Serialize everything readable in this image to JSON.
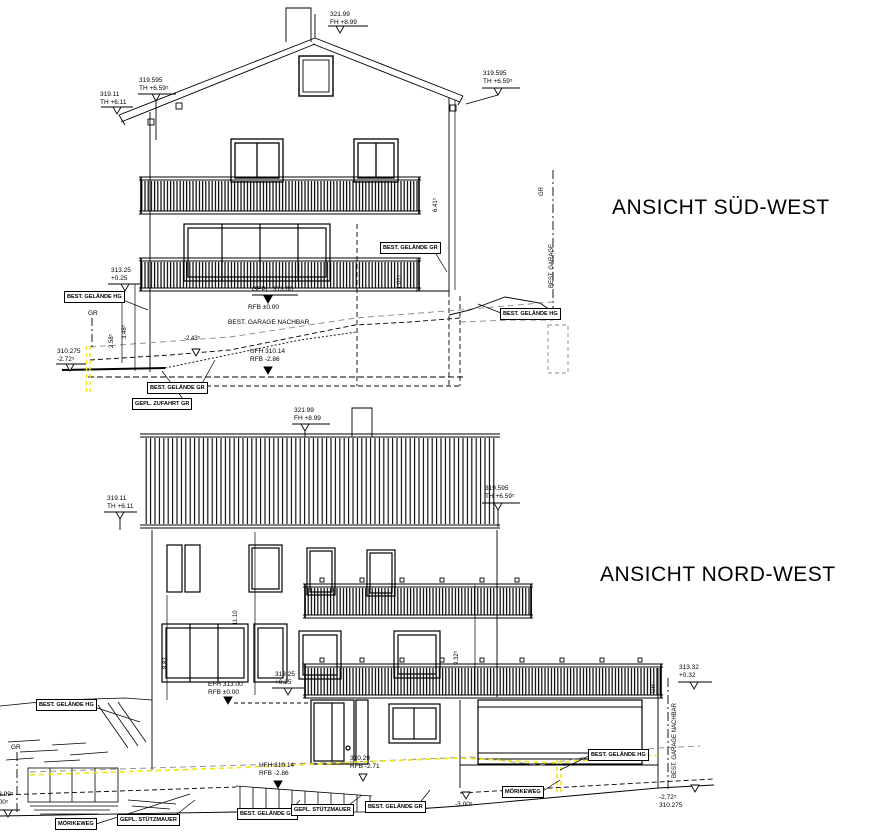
{
  "titles": {
    "sued_west": "ANSICHT SÜD-WEST",
    "nord_west": "ANSICHT NORD-WEST"
  },
  "colors": {
    "line": "#000000",
    "terrain_dash": "#8a8a8a",
    "highlight_yellow": "#f0e612"
  },
  "labels": {
    "sw_ridge": "321.99\nFH +8.99",
    "sw_eave_left_outer": "319.11\nTH +6.11",
    "sw_eave_left_inner": "319.595\nTH +6.59⁵",
    "sw_eave_right": "319.595\nTH +6.59⁵",
    "sw_level_31325": "313.25\n+0.25",
    "sw_hg_left": "BEST. GELÄNDE HG",
    "sw_gr_left": "GR",
    "sw_gepl": "GEPL. 313.00",
    "sw_rfb0": "RFB ±0.00",
    "sw_garage_nachbar": "BEST. GARAGE NACHBAR",
    "sw_ufh": "UFH 310.14\nRFB -2.86",
    "sw_gr_mid": "BEST. GELÄNDE GR",
    "sw_gr_right": "GR",
    "sw_garage_vert": "BEST. GARAGE",
    "sw_hg_right": "BEST. GELÄNDE HG",
    "sw_level_310275": "310.275\n-2.72⁵",
    "sw_gr_bottom": "BEST. GELÄNDE GR",
    "sw_zufahrt": "GEPL. ZUFAHRT GR",
    "sw_dim_258": "2.58⁵",
    "sw_dim_348": "3.48⁵",
    "sw_dim_243": "-2.43⁵",
    "sw_dim_641": "6.41⁵",
    "sw_dim_101": "1.01⁵",
    "nw_ridge": "321.99\nFH +8.99",
    "nw_eave_left": "319.11\nTH +6.11",
    "nw_eave_right": "319.595\nTH +6.59⁵",
    "nw_dim_1110": "11.10",
    "nw_dim_882": "8.82",
    "nw_dim_9325": "9.32⁵",
    "nw_level_31325": "313.25\n+0.25",
    "nw_efh": "EFH 313.00\nRFB ±0.00",
    "nw_level_31332": "313.32\n+0.32",
    "nw_gr_right": "GR",
    "nw_garage_nachbar_vert": "BEST. GARAGE NACHBAR",
    "nw_hg_left": "BEST. GELÄNDE HG",
    "nw_gr_left": "GR",
    "nw_level_30899": "308.99⁵\n-4.00⁵",
    "nw_ufh": "UFH 310.14\nRFB -2.86",
    "nw_level_31029": "310.29\nRFB -2.71",
    "nw_morikeweg_left": "MÖRIKEWEG",
    "nw_stutzmauer_left": "GEPL. STÜTZMAUER",
    "nw_gelaende_gr_1": "BEST. GELÄNDE GR",
    "nw_stutzmauer_mid": "GEPL. STÜTZMAUER",
    "nw_gelaende_gr_2": "BEST. GELÄNDE GR",
    "nw_level_m300": "-3.00⁵",
    "nw_morikeweg_right": "MÖRIKEWEG",
    "nw_hg_right": "BEST. GELÄNDE HG",
    "nw_level_272": "-2.72⁵\n310.275"
  }
}
